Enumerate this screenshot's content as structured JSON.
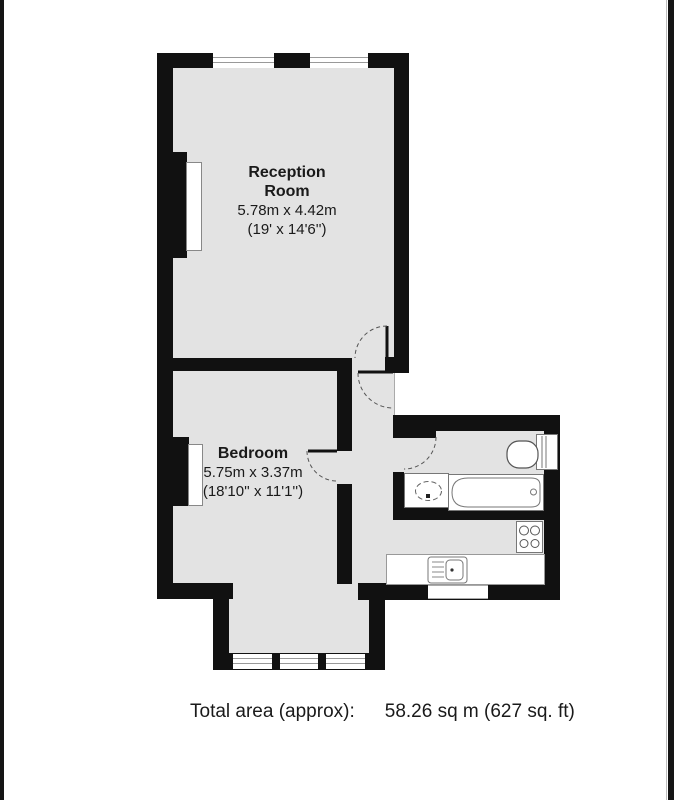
{
  "document": {
    "type": "estate-agent-floor-plan",
    "background": "#ffffff"
  },
  "colors": {
    "wall": "#111111",
    "floor_fill": "#e3e3e3",
    "fixture_border": "#777777",
    "text": "#1a1a1a"
  },
  "rooms": {
    "reception": {
      "name_line1": "Reception",
      "name_line2": "Room",
      "dimensions_metric": "5.78m x 4.42m",
      "dimensions_imperial": "(19' x 14'6'')"
    },
    "bedroom": {
      "name": "Bedroom",
      "dimensions_metric": "5.75m x 3.37m",
      "dimensions_imperial": "(18'10'' x 11'1'')"
    }
  },
  "footer": {
    "total_area_label": "Total area (approx):",
    "total_area_value": "58.26 sq m (627 sq. ft)"
  },
  "fixtures": {
    "bathroom": [
      "toilet",
      "wash-basin",
      "bathtub"
    ],
    "kitchen": [
      "hob",
      "kitchen-sink",
      "window"
    ],
    "reception": [
      "radiator",
      "double-window",
      "double-window"
    ],
    "bedroom": [
      "radiator",
      "bay-window-triple"
    ],
    "doors": [
      "reception-door",
      "entrance-door",
      "bedroom-door",
      "bathroom-door"
    ]
  }
}
